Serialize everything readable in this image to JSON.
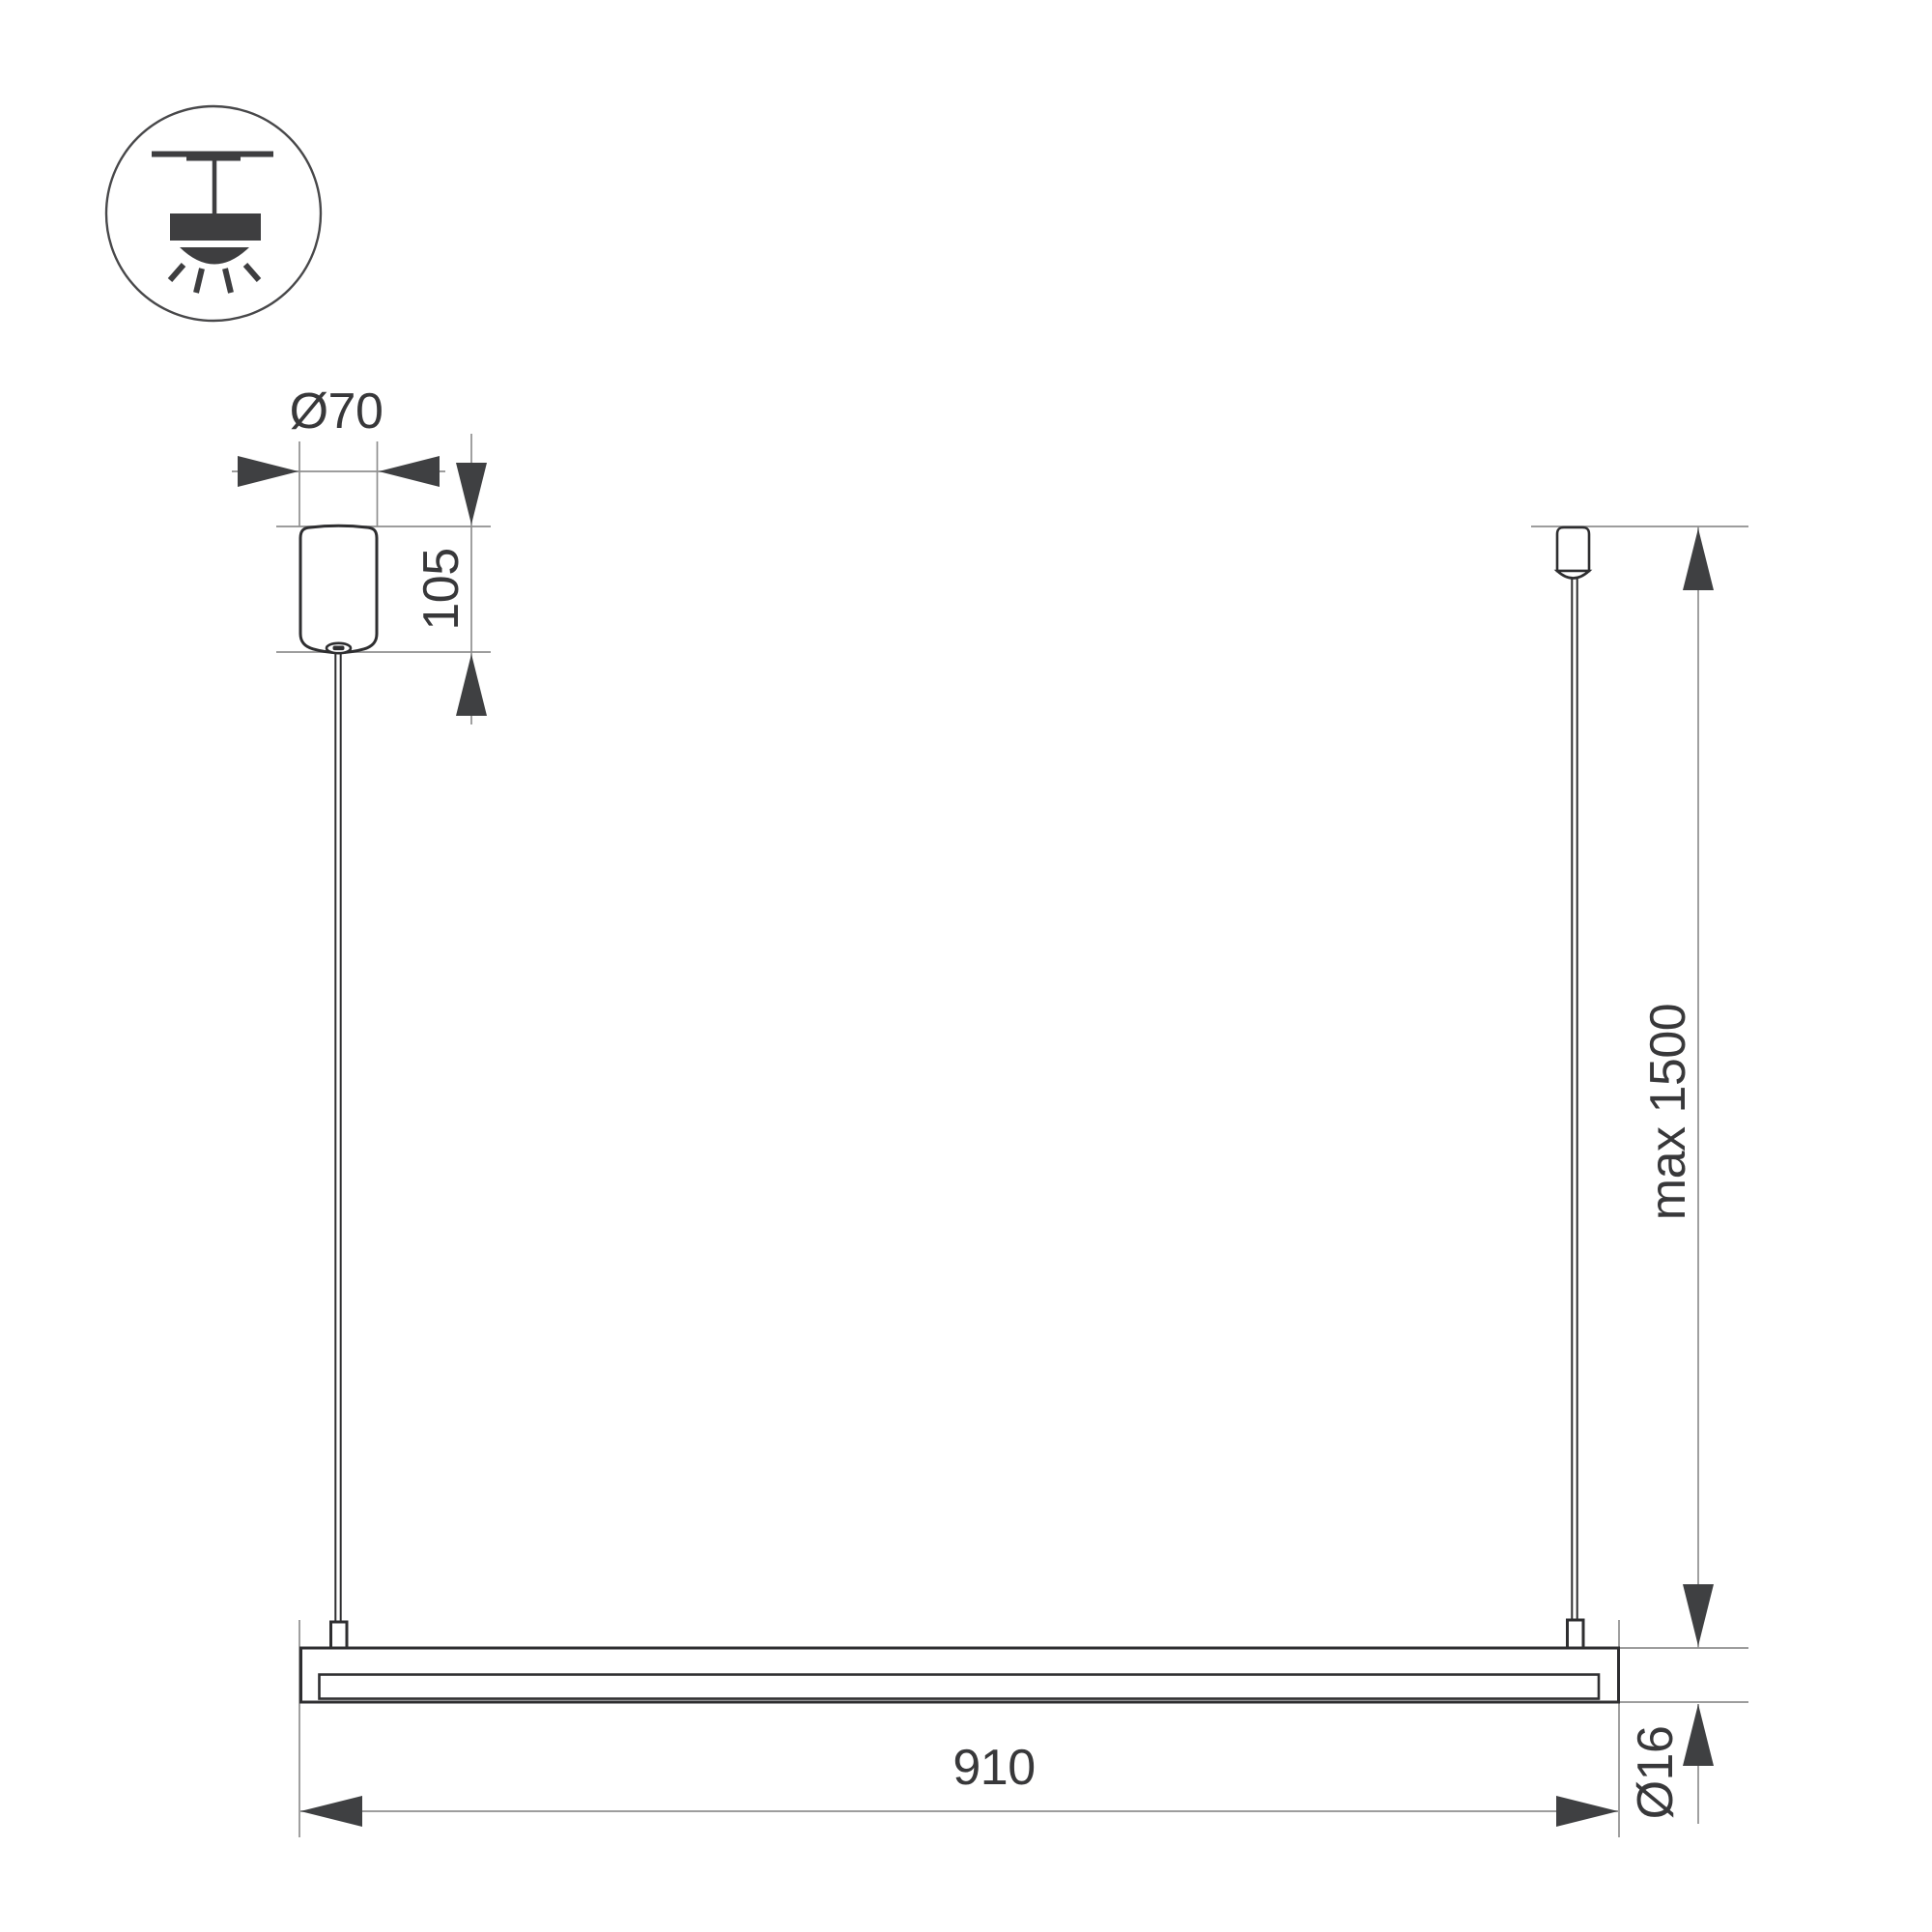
{
  "icon": {
    "name": "ceiling-pendant-mount-icon"
  },
  "dimensions": {
    "canopy_diameter": "Ø70",
    "canopy_height": "105",
    "max_suspension": "max 1500",
    "fixture_length": "910",
    "tube_diameter": "Ø16"
  },
  "colors": {
    "background": "#ffffff",
    "object_line": "#2e2e30",
    "dimension_line": "#8f8f8f",
    "arrow": "#3f4042",
    "text": "#38383a"
  }
}
